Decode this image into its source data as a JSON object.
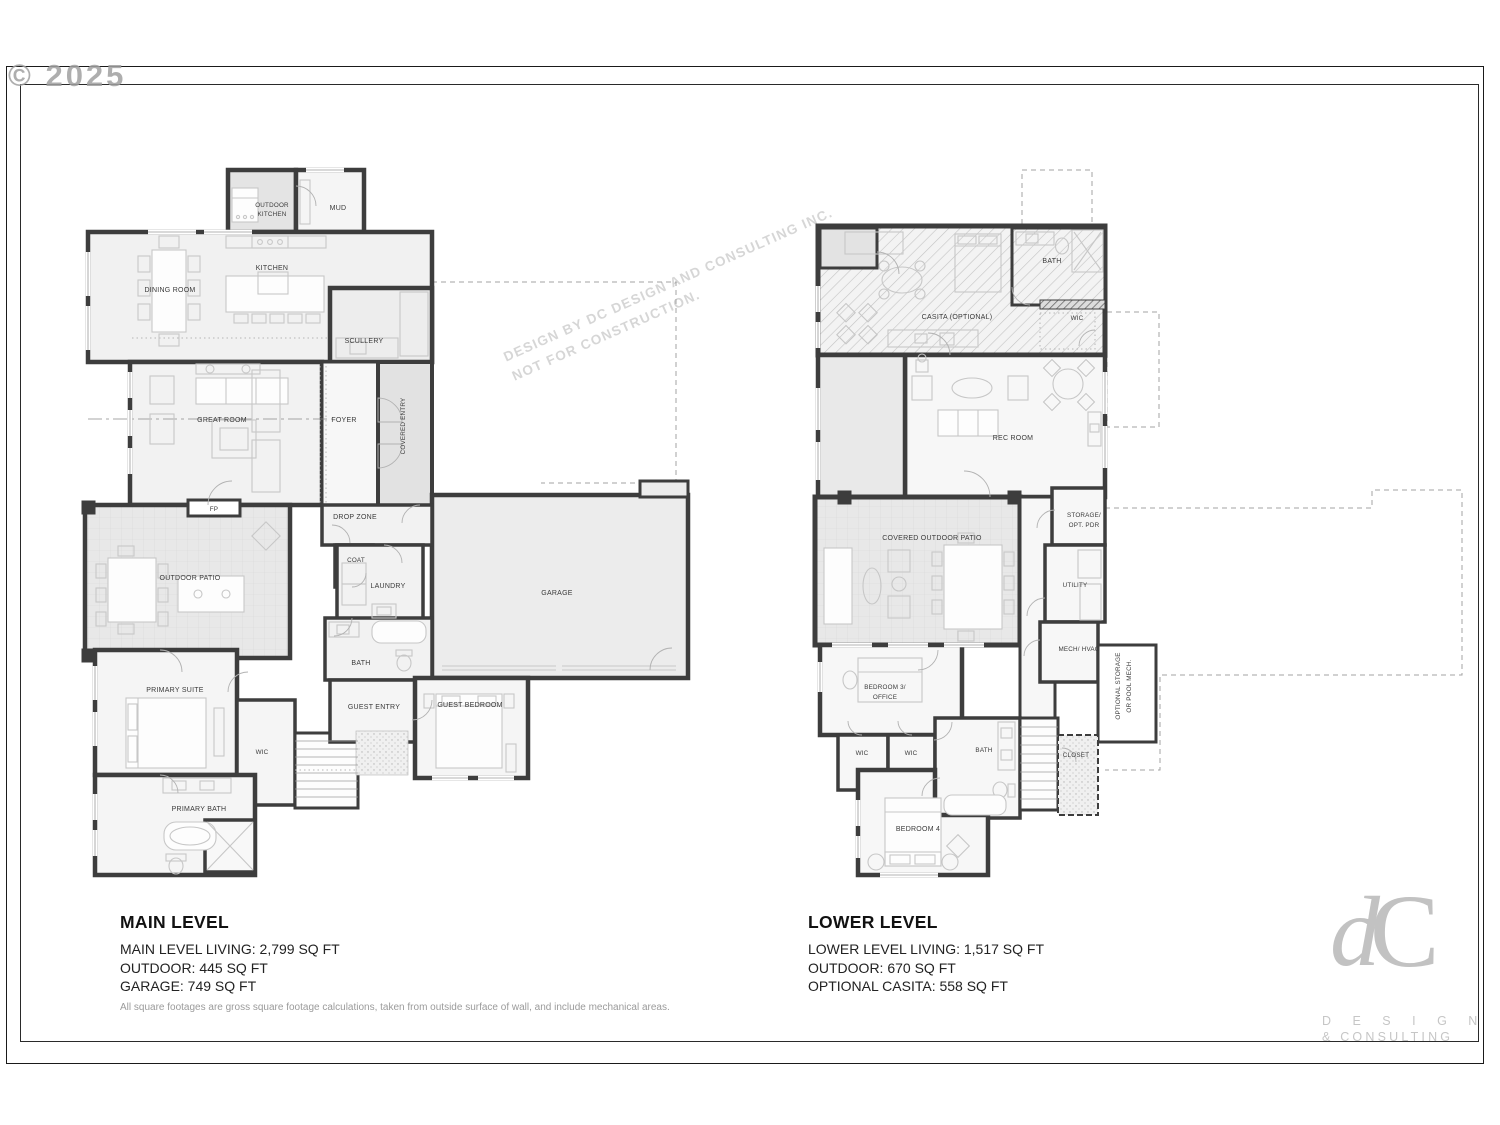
{
  "page": {
    "copyright": "© 2025",
    "watermark_line1": "DESIGN BY DC DESIGN AND CONSULTING INC.",
    "watermark_line2": "NOT FOR CONSTRUCTION.",
    "footnote": "All square footages are gross square footage calculations, taken from outside surface of wall, and include mechanical areas."
  },
  "colors": {
    "wall": "#3d3d3d",
    "floor": "#f2f2f2",
    "shaded_area": "#e7e7e7",
    "furniture_line": "#c7c7c7",
    "label_text": "#3a3a3a",
    "logo_gray": "#c2c2c2",
    "watermark_gray": "#d4d4d4"
  },
  "main_level": {
    "title": "MAIN LEVEL",
    "stats": [
      "MAIN LEVEL LIVING: 2,799 SQ FT",
      "OUTDOOR: 445 SQ FT",
      "GARAGE: 749 SQ FT"
    ]
  },
  "lower_level": {
    "title": "LOWER LEVEL",
    "stats": [
      "LOWER LEVEL LIVING: 1,517 SQ FT",
      "OUTDOOR: 670 SQ FT",
      "OPTIONAL CASITA: 558 SQ FT"
    ]
  },
  "main_rooms": {
    "outdoor_kitchen_1": "OUTDOOR",
    "outdoor_kitchen_2": "KITCHEN",
    "mud": "MUD",
    "kitchen": "KITCHEN",
    "dining_room": "DINING ROOM",
    "scullery": "SCULLERY",
    "great_room": "GREAT ROOM",
    "foyer": "FOYER",
    "covered_entry": "COVERED ENTRY",
    "fp": "FP",
    "drop_zone": "DROP ZONE",
    "coat": "COAT",
    "laundry": "LAUNDRY",
    "outdoor_patio": "OUTDOOR PATIO",
    "garage": "GARAGE",
    "bath": "BATH",
    "primary_suite": "PRIMARY SUITE",
    "guest_entry": "GUEST ENTRY",
    "guest_bedroom": "GUEST BEDROOM",
    "wic": "WIC",
    "primary_bath": "PRIMARY BATH"
  },
  "lower_rooms": {
    "bath": "BATH",
    "casita": "CASITA (OPTIONAL)",
    "wic": "WIC",
    "rec_room": "REC ROOM",
    "storage_1": "STORAGE/",
    "storage_2": "OPT. PDR",
    "covered_outdoor_patio": "COVERED OUTDOOR PATIO",
    "utility": "UTILITY",
    "mech_hvac": "MECH/ HVAC",
    "bedroom3_1": "BEDROOM 3/",
    "bedroom3_2": "OFFICE",
    "opt_storage_1": "OPTIONAL STORAGE",
    "opt_storage_2": "OR POOL MECH.",
    "wic_a": "WIC",
    "wic_b": "WIC",
    "bath2": "BATH",
    "closet": "CLOSET",
    "bedroom4": "BEDROOM 4"
  },
  "logo": {
    "mark_d": "d",
    "mark_c": "C",
    "line1": "D E S I G N",
    "line2": "& CONSULTING"
  }
}
